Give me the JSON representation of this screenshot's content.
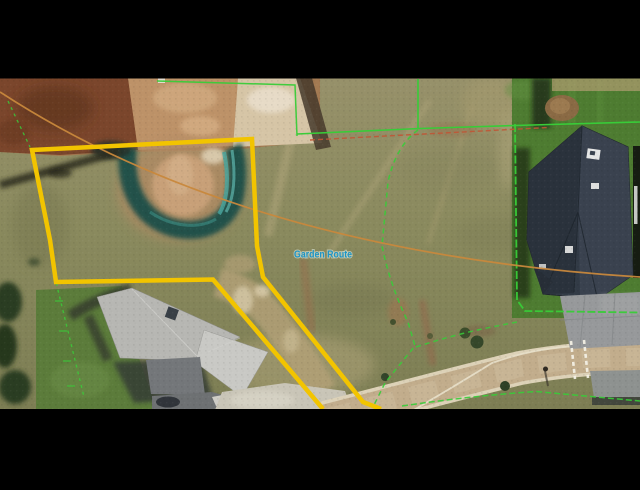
{
  "canvas": {
    "width": 640,
    "height": 490
  },
  "letterbox": {
    "color": "#000000"
  },
  "map": {
    "street_label": "Garden Route",
    "street_label_color": "#1d95c7"
  },
  "overlay": {
    "parcel_highlight_color": "#f2c400",
    "parcel_line_green": "#38cc38",
    "parcel_line_orange": "#c8883c",
    "parcel_line_red": "#c05535",
    "road_marking_white": "#f2efe4"
  }
}
